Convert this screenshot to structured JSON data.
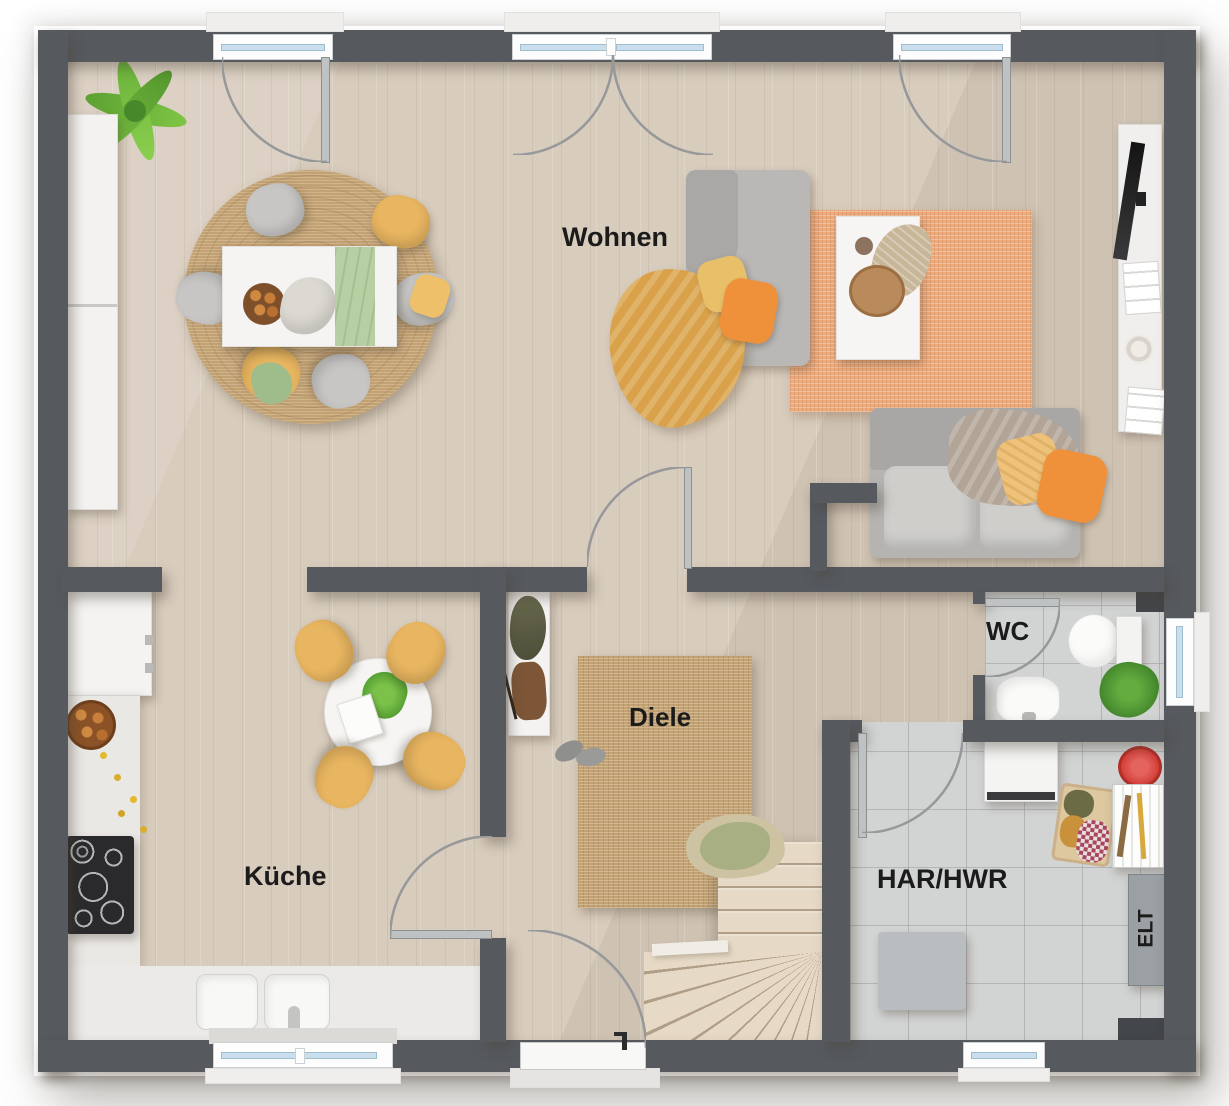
{
  "plan": {
    "type": "floor-plan-top-view"
  },
  "rooms": {
    "wohnen": {
      "label": "Wohnen"
    },
    "kueche": {
      "label": "Küche"
    },
    "diele": {
      "label": "Diele"
    },
    "wc": {
      "label": "WC"
    },
    "har_hwr": {
      "label": "HAR/HWR"
    },
    "elt": {
      "label": "ELT"
    }
  },
  "colors": {
    "wall": "#565a5f",
    "wood": "#d8ccbd",
    "tile": "#d2d4d4",
    "jute": "#c2a173",
    "rug_orange": "#eeab7e",
    "stair": "#e6d9c5",
    "accent_yellow": "#e8b560",
    "accent_orange": "#ef913a",
    "sofa_gray": "#b9b8b6",
    "glass": "#cadeed",
    "label": "#1b1b1b"
  }
}
